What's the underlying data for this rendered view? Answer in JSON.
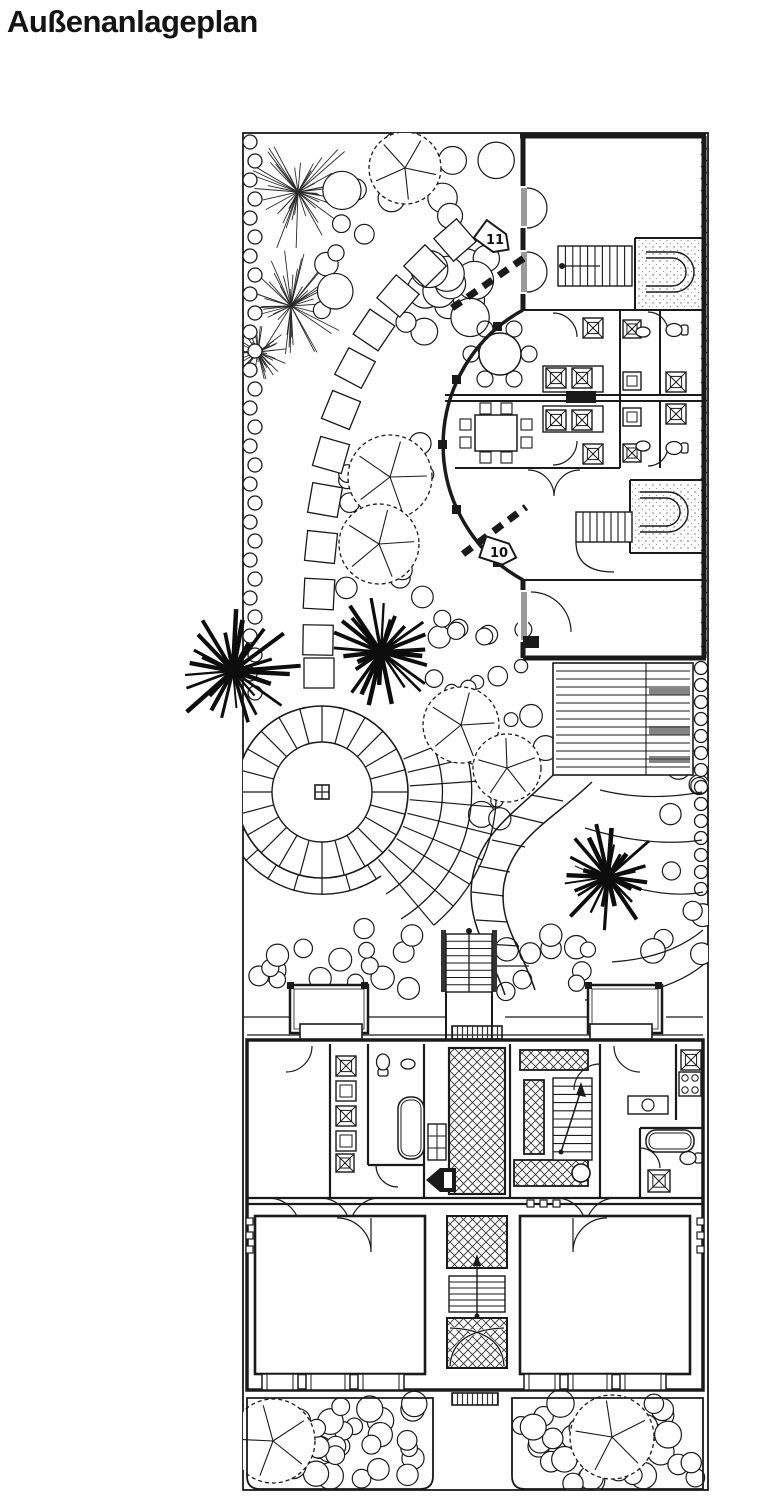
{
  "page": {
    "background": "#ffffff",
    "ink": "#1a1a1a",
    "title_color": "#141414"
  },
  "header": {
    "title": "Außenanlageplan"
  },
  "plan": {
    "markers": [
      {
        "label": "11"
      },
      {
        "label": "10"
      }
    ]
  }
}
